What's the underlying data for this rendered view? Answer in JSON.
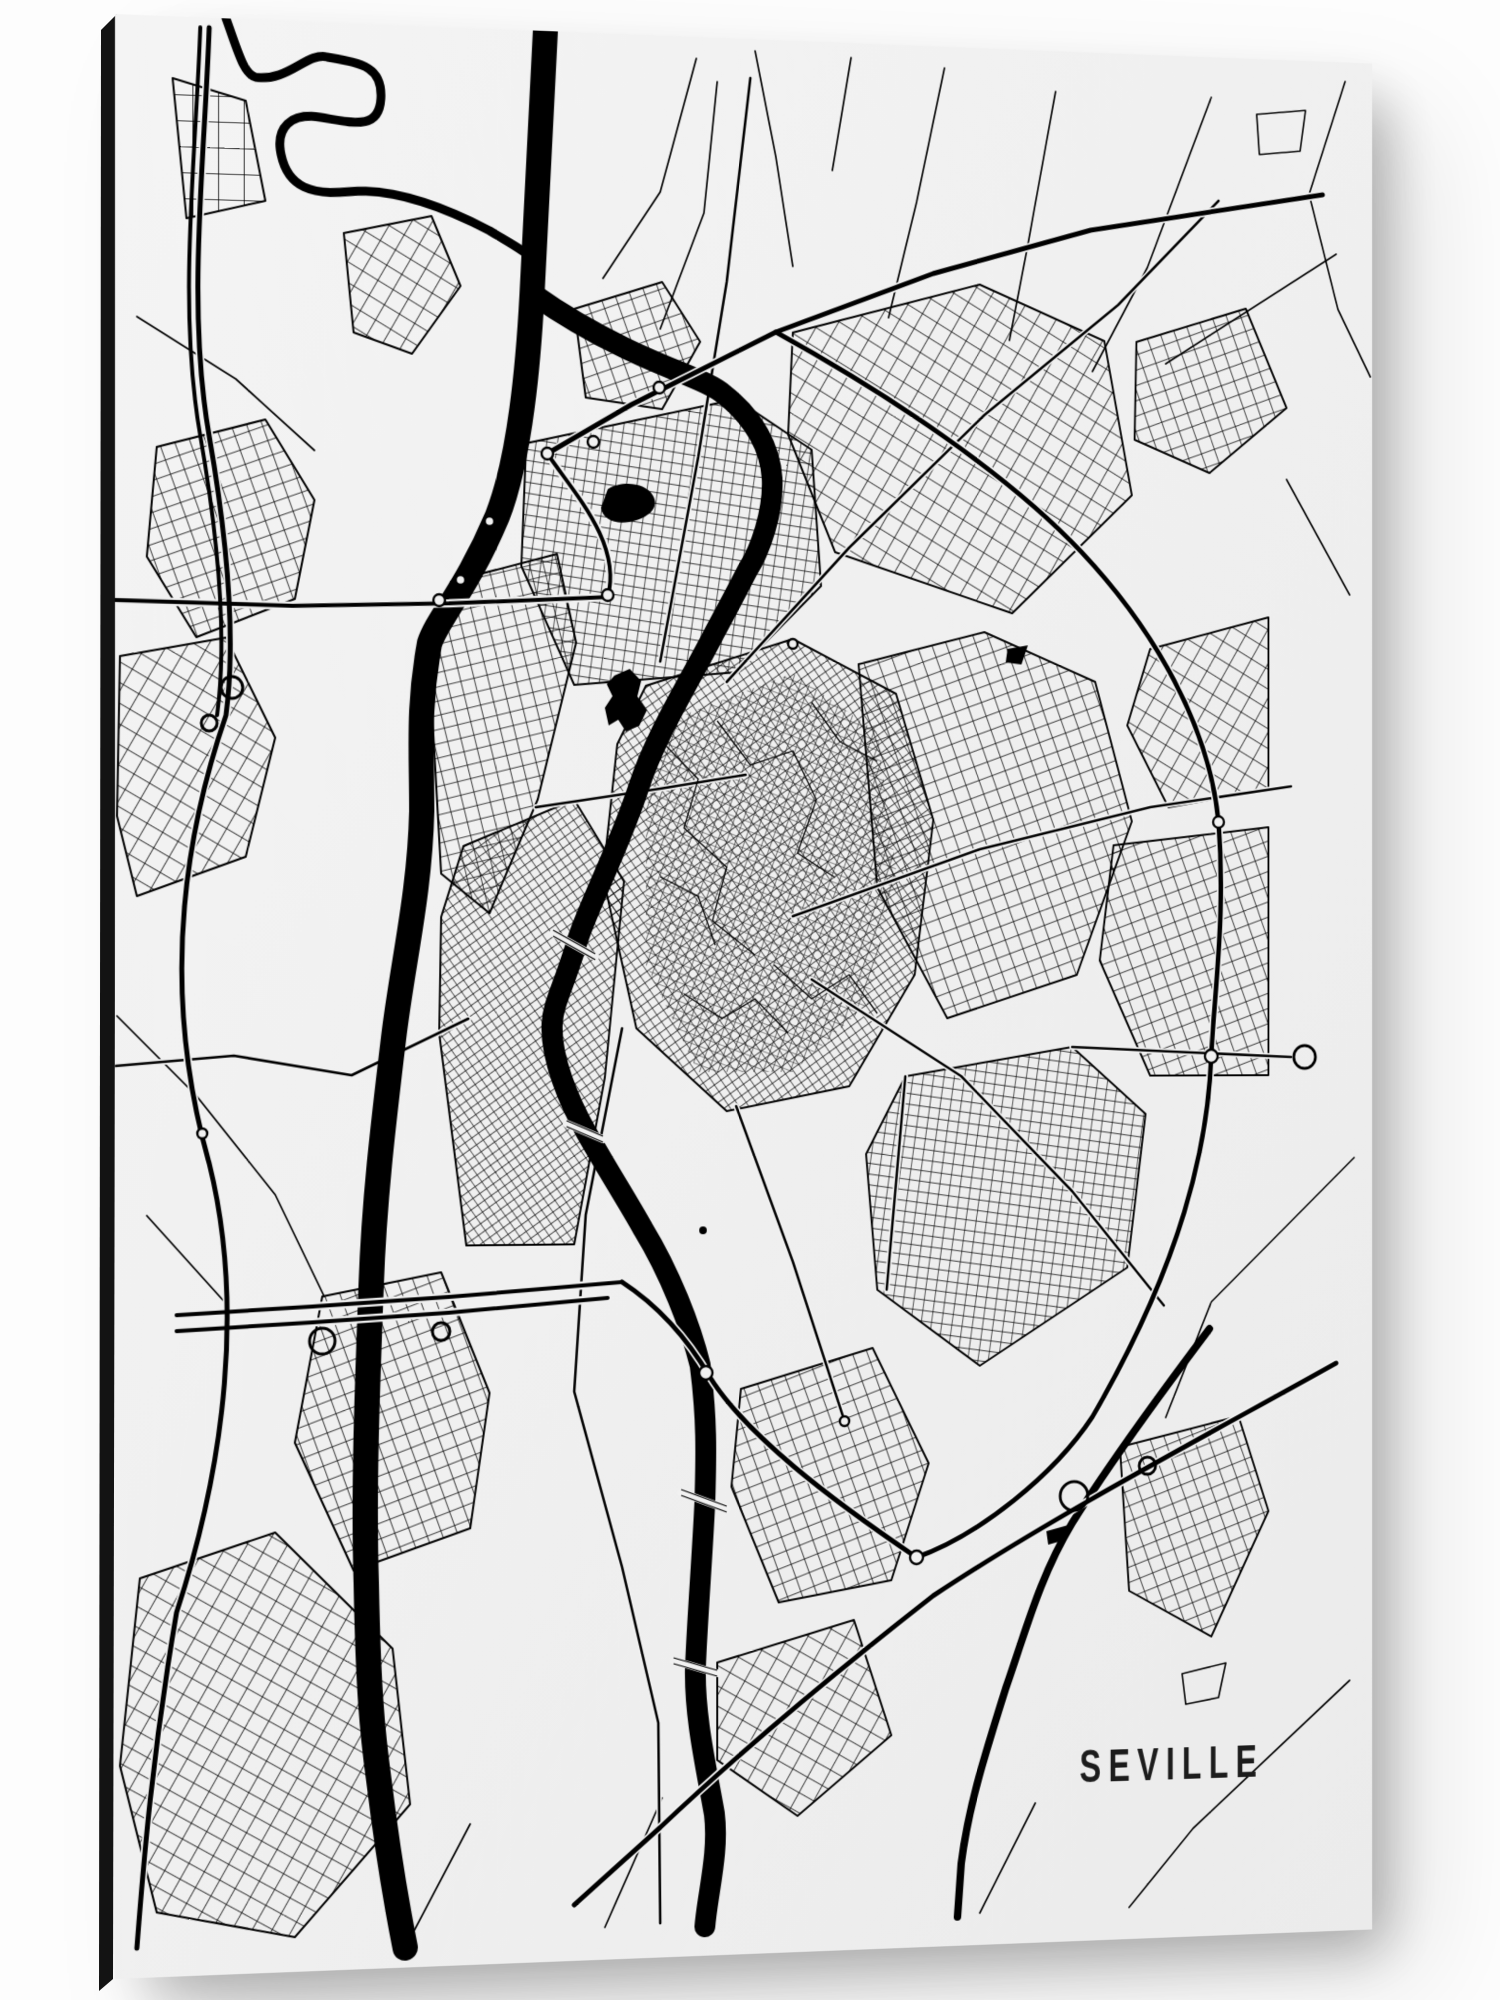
{
  "artwork": {
    "title": "SEVILLE",
    "kind": "black-and-white city street map art print on panel"
  },
  "colors": {
    "background": "#fdfdfd",
    "paper_light": "#f4f4f4",
    "paper_dark": "#ebebeb",
    "ink": "#000000",
    "title_ink": "#1c1c1c",
    "panel_edge": "#131313"
  },
  "map_features": {
    "water": [
      "river-main-channel",
      "river-meander",
      "city-canal",
      "southeast-stream",
      "park-ponds"
    ],
    "roads": [
      "west-bypass-motorway",
      "north-highway",
      "northeast-motorway",
      "east-ring-road",
      "south-ring-motorway",
      "southeast-motorway",
      "city-streets"
    ],
    "symbols": [
      "roundabouts",
      "bridges",
      "interchange-loops"
    ]
  }
}
